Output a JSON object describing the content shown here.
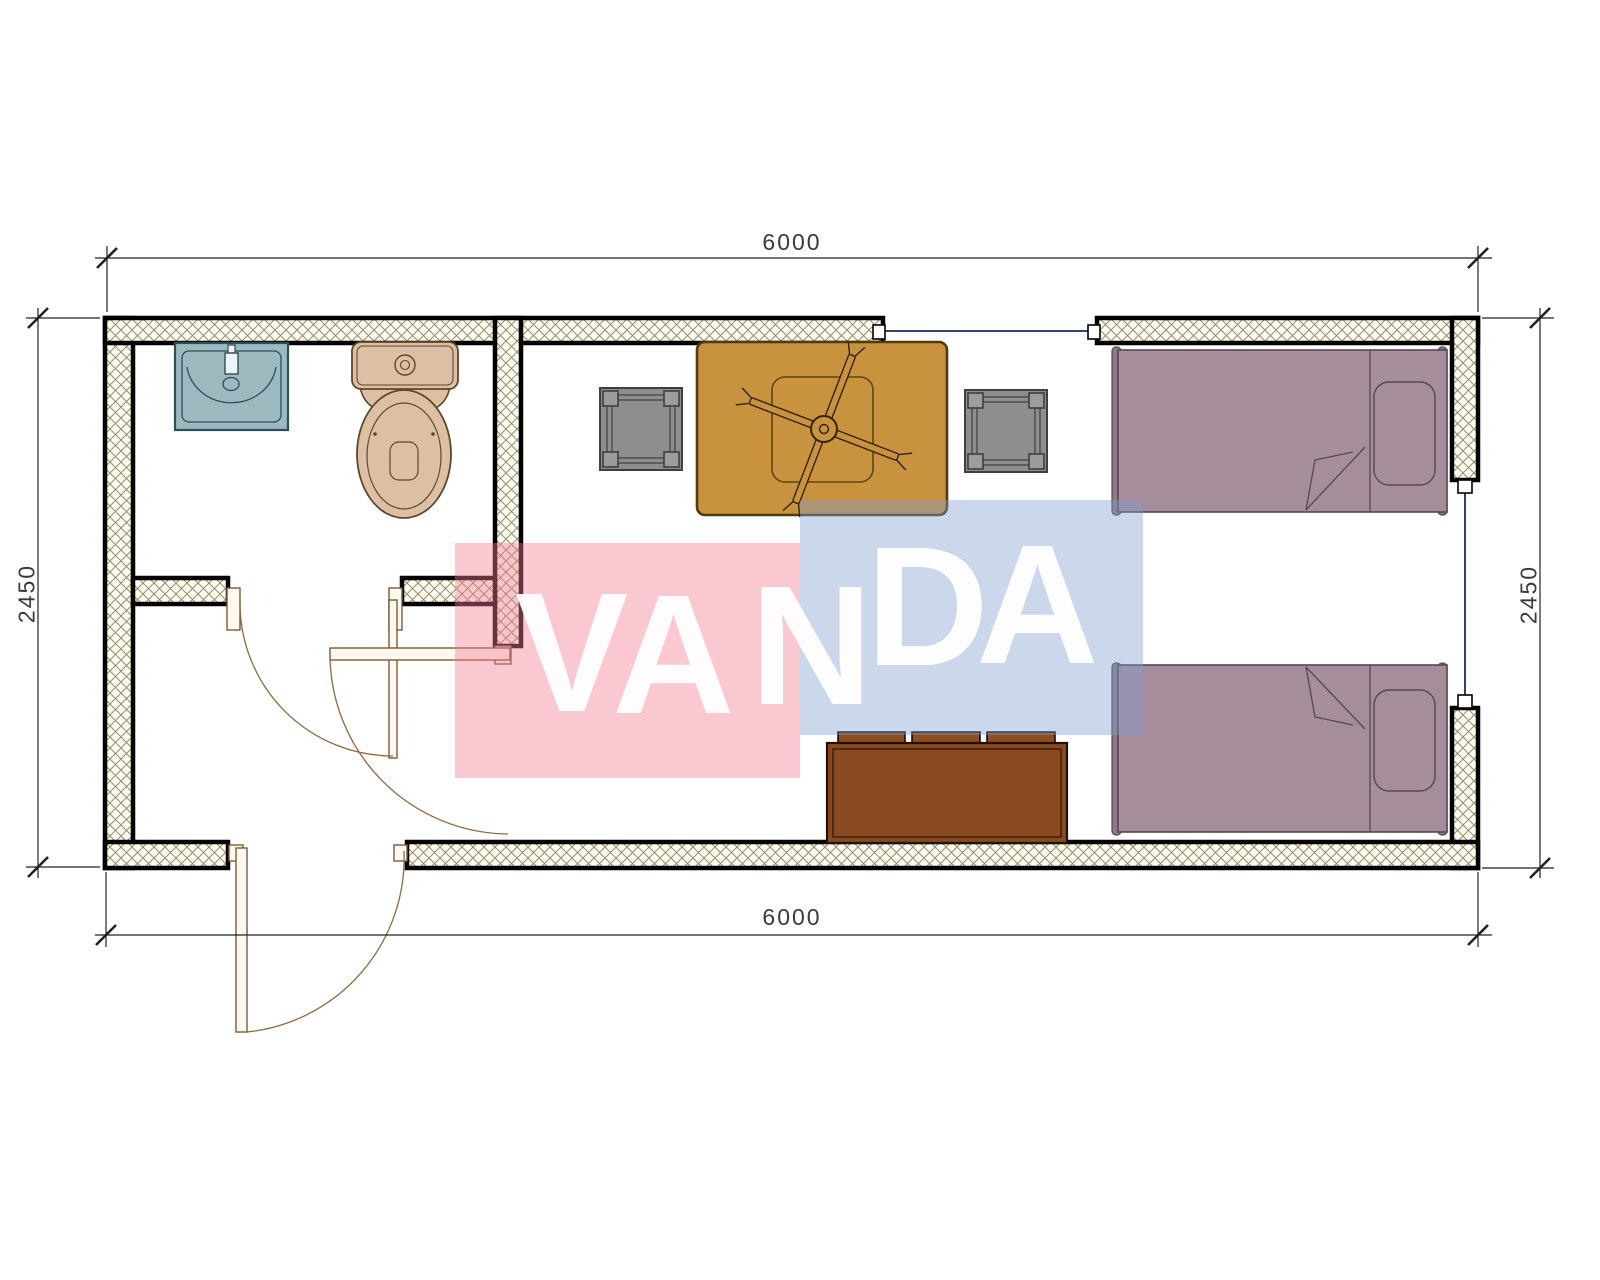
{
  "drawing": {
    "type": "floor-plan",
    "description": "Single container cabin plan: bathroom with sink and toilet at left, entry hall with three swing doors, living room with dining table, ceiling fan, two stools, bench sofa and two single beds",
    "overall_width_label": "6000",
    "overall_depth_label": "2450"
  },
  "dimensions": {
    "top": "6000",
    "bottom": "6000",
    "left": "2450",
    "right": "2450"
  },
  "watermark": {
    "text": "VANDA",
    "pink_block_color": "#f07d91",
    "blue_block_color": "#7d9ecd",
    "letter_color": "#ffffff",
    "letters": [
      {
        "ch": "V",
        "left": 515,
        "top": 568
      },
      {
        "ch": "A",
        "left": 612,
        "top": 570
      },
      {
        "ch": "N",
        "left": 750,
        "top": 561
      },
      {
        "ch": "D",
        "left": 866,
        "top": 522
      },
      {
        "ch": "A",
        "left": 976,
        "top": 520
      }
    ]
  },
  "symbols": {
    "walls_hatch_line_color": "#9b8d5f",
    "window_line_color": "#1b2a5e",
    "door_arc_color": "#8a6b3f",
    "dimension_text_color": "#3a3a3a",
    "sink_color": "#9cb9c0",
    "toilet_color": "#dcc0a5",
    "table_color": "#c8923e",
    "stool_color": "#8e8e8e",
    "bench_color": "#8a4a1f",
    "bed_color": "#a58d9c",
    "items": [
      "sink",
      "toilet",
      "ceiling-fan",
      "dining-table",
      "stool-left",
      "stool-right",
      "bench-sofa",
      "bed-top",
      "bed-bottom",
      "bathroom-door",
      "living-room-door",
      "entrance-door",
      "window-top",
      "window-right"
    ]
  }
}
